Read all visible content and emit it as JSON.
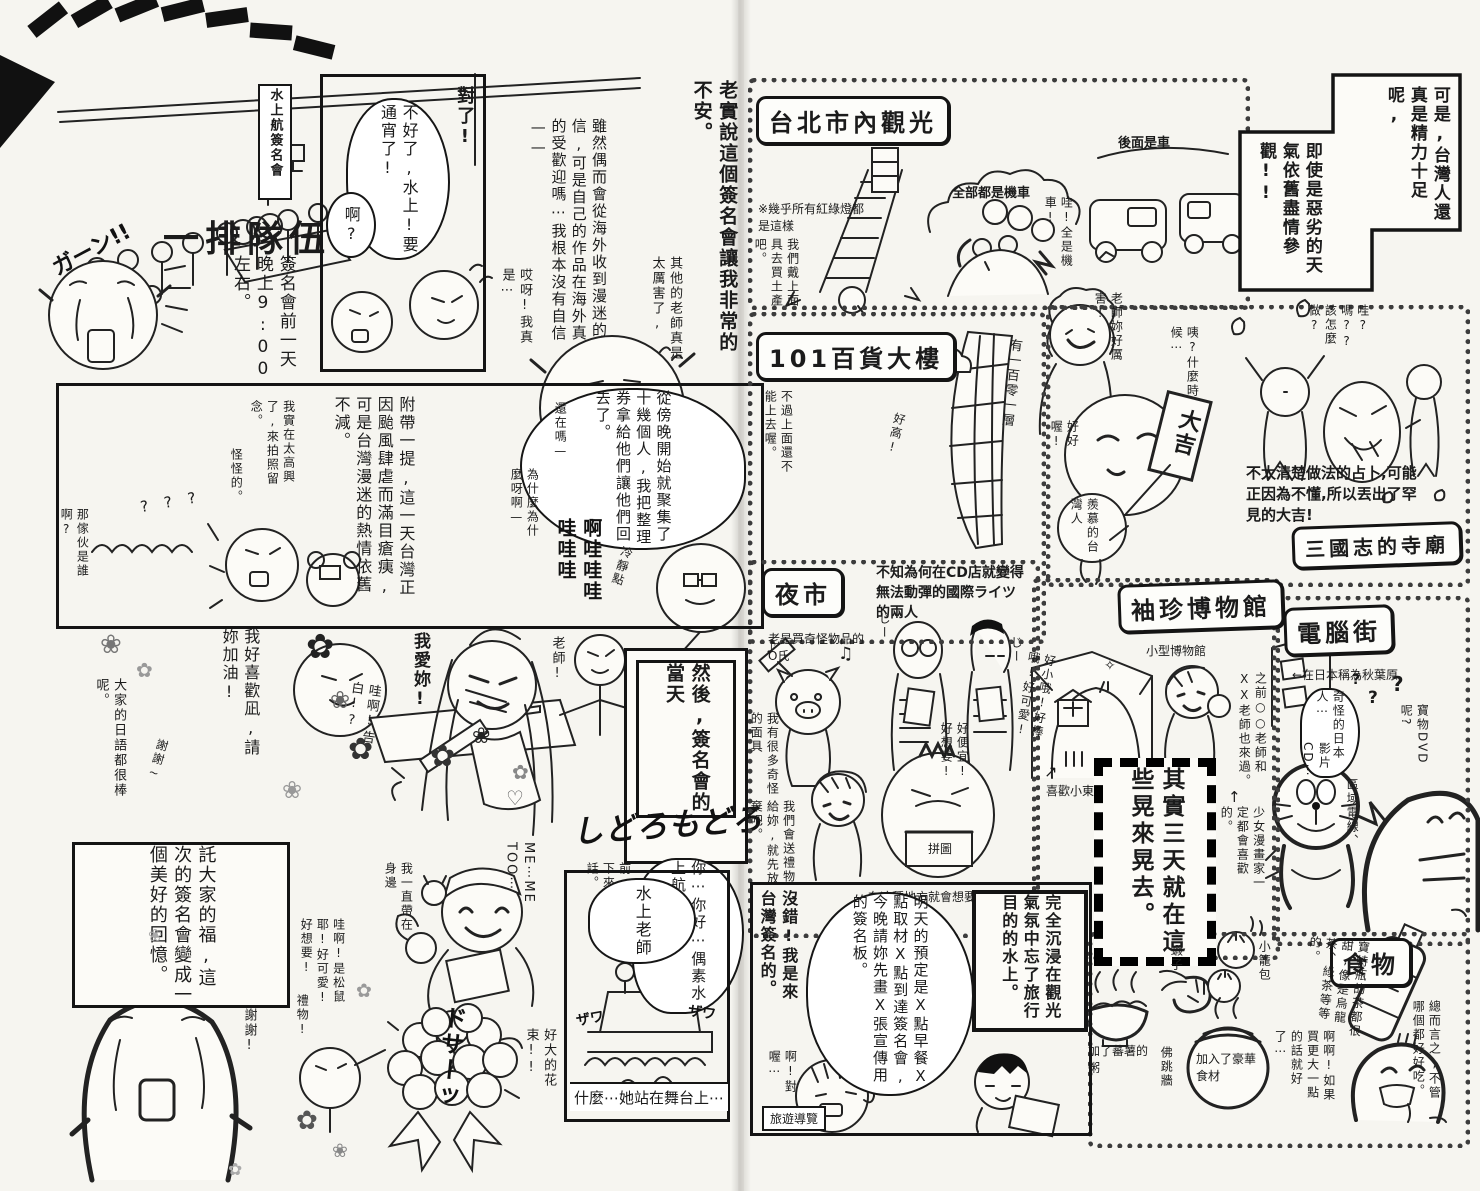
{
  "left_page": {
    "sign_board": "水上航簽名會",
    "queue_title": "一排隊伍",
    "queue_caption": "簽名會前一天晚上9:00左右。",
    "sfx_gaan": "ガーン!!",
    "panel_allnighter": {
      "exclaim": "對了!",
      "bubble": "不好了,水上!要通宵了!",
      "reply": "啊?"
    },
    "monologue": {
      "intro": "老實說這個簽名會讓我非常的不安。",
      "worry": "雖然偶而會從海外收到漫迷的信,可是自己的作品在海外真的受歡迎嗎⋯我根本沒有自信——",
      "others": "其他的老師真是太厲害了,",
      "sigh": "哎呀!我真是⋯"
    },
    "panel_typhoon": {
      "caption": "附帶一提,這一天台灣正因颱風肆虐而滿目瘡痍,可是台灣漫迷的熱情依舊不減。",
      "bubble": "從傍晚開始就聚集了十幾個人,我把整理券拿給他們讓他們回去了。",
      "still_there": "還在嗎—",
      "why": "為什麼為什麼呀啊—",
      "sfx_wail": "啊哇哇哇哇哇哇",
      "calm_down": "冷靜點",
      "photo": "我實在太高興了,來拍照留念。",
      "strange": "怪怪的。",
      "who": "那傢伙是誰啊?",
      "sfx_question": "???"
    },
    "panel_day": {
      "caption": "然後,簽名會的當天"
    },
    "fan_scene": {
      "cheer": "我好喜歡凪,請妳加油!",
      "praise": "大家的日語都很棒呢。",
      "thanks": "謝謝~",
      "confession": "哇啊!告白!?",
      "love": "我愛妳!",
      "sensei": "老師!",
      "memory_box": "託大家的福,這次的簽名會變成一個美好的回憶。",
      "thanks2": "謝謝!",
      "gift": "禮物!",
      "squirrel": "哇啊!是松鼠耶!好可愛!好想要!",
      "keepsake": "我一直帶在身邊",
      "me_too": "ME⋯ME TOO⋯",
      "memo": "前一晚緊急背下來的台灣話。",
      "greeting": "你⋯你好⋯偶素水上航老師",
      "sfx_flustered": "しどろもどろ",
      "bouquet": "好大的花束!!",
      "sfx_thud": "ドサーッ"
    },
    "panel_stage": {
      "bubble": "水上老師",
      "caption": "什麼⋯她站在舞台上⋯",
      "sfx_zawa": "ザワ"
    }
  },
  "right_page": {
    "city_tour": {
      "title": "台北市內觀光",
      "note": "※幾乎所有紅綠燈都是這樣",
      "scooters_label": "全部都是機車",
      "cars_label": "後面是車",
      "wow": "哇!全是機車!",
      "souvenir": "我們戴上面具去買土產吧。"
    },
    "energy_note": {
      "line1": "可是,台灣人還真是精力十足呢,",
      "line2": "即使是惡劣的天氣依舊盡情參觀!!"
    },
    "tower101": {
      "title": "101百貨大樓",
      "floors": "有一百零一層",
      "closed": "不過上面還不能上去喔。",
      "tall": "好高!",
      "praise": "老師妳好厲害!",
      "when": "咦?什麼時候⋯",
      "nice": "好好喔!",
      "envy": "羨慕的台灣人",
      "fortune": "大吉",
      "how": "哇?嗎??該怎麼做?",
      "caption": "不太清楚做法的占卜,可能正因為不懂,所以丟出了罕見的大吉!",
      "temple": "三國志的寺廟"
    },
    "night_market": {
      "title": "夜市",
      "cd_caption": "不知為何在CD店就變得無法動彈的國際ライツ的兩人",
      "sfx_stare": "じー",
      "odd_goods": "老是買奇怪物品的O氏",
      "masks": "我有很多奇怪的面具",
      "give_up": "我們會送禮物給妳,就先放棄吧。",
      "bargain": "好便宜!好想要!",
      "puzzle": "拼圖",
      "puzzle_caption": "在這種地方就會想要買拼圖的水上",
      "small_cute": "好小哦!好棒哦!好可愛!"
    },
    "museum": {
      "title": "袖珍博物館",
      "subtitle": "小型博物館",
      "likes_small": "喜歡小東西",
      "visitors": "之前○○老師和XX老師也來過。",
      "shoujo": "少女漫畫家一定都會喜歡的。",
      "wander_box": "其實三天就在這些晃來晃去。"
    },
    "pc_street": {
      "title": "電腦街",
      "akihabara": "←在日本稱為秋葉原",
      "weird_japanese": "奇怪的日本人⋯",
      "dvd": "寶物DVD呢?",
      "cd": "影片CD⋯",
      "region": "區域電線、"
    },
    "food": {
      "title": "食物",
      "shrimp": "蝦子",
      "bun": "小籠包",
      "porridge": "加了蕃薯的粥",
      "pot": "佛跳牆",
      "pot_note": "加入了豪華食材",
      "tea": "寶特瓶的茶都很甜,像是烏龍茶、綠茶等等的。",
      "verdict": "總而言之,不管哪個都好好吃。",
      "bigger": "啊啊!如果買更大一點的話就好了⋯"
    },
    "panel_purpose": {
      "caption": "完全沉浸在觀光氣氛中忘了旅行目的的水上。",
      "schedule": "明天的預定是X點早餐X點取材X點到達簽名會,今晚請妳先畫X張宣傳用的簽名板。",
      "declare": "沒錯!我是來台灣簽名的。",
      "oh_right": "啊!對喔⋯",
      "guidebook": "旅遊導覽"
    }
  }
}
